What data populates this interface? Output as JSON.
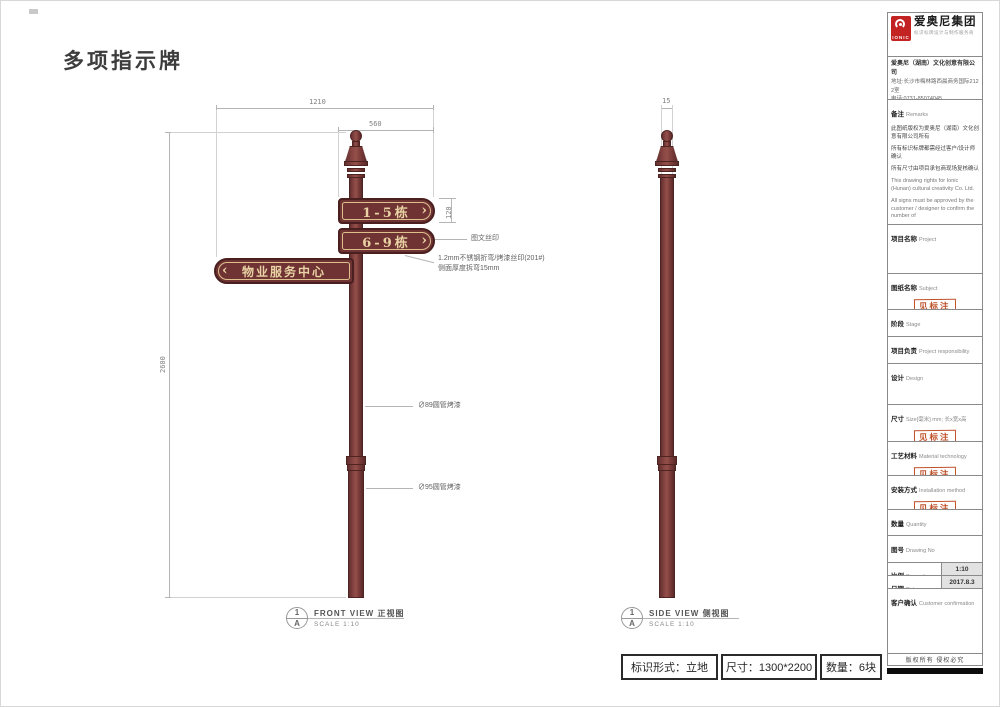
{
  "page": {
    "title": "多项指示牌",
    "copyright": "版权所有 侵权必究"
  },
  "drawing": {
    "plates": {
      "plate1": "1-5栋",
      "plate2": "6-9栋",
      "plate3": "物业服务中心",
      "arrow_right": "›",
      "arrow_left": "‹"
    },
    "dimensions": {
      "total_width": "1210",
      "plate_length": "560",
      "plate_height": "120",
      "pole_height": "2600",
      "side_thickness": "15"
    },
    "annotations": {
      "silkscreen": "图文丝印",
      "material_note_1": "1.2mm不锈钢折弯/烤漆丝印(201#)",
      "material_note_2": "侧面厚度拆弯15mm",
      "pipe_89": "∅89圆管烤漆",
      "pipe_95": "∅95圆管烤漆"
    },
    "front_view": {
      "ref_number": "1",
      "ref_letter": "A",
      "title": "FRONT VIEW  正视图",
      "scale": "SCALE 1:10"
    },
    "side_view": {
      "ref_number": "1",
      "ref_letter": "A",
      "title": "SIDE VIEW   侧视图",
      "scale": "SCALE 1:10"
    }
  },
  "footer_bar": {
    "cell1": "标识形式：立地",
    "cell2": "尺寸：1300*2200",
    "cell3": "数量：6块"
  },
  "sidebar": {
    "logo": {
      "brand_mark_text": "IONIC",
      "group_name": "爱奥尼集团",
      "tagline": "标识标牌设计与制作服务商"
    },
    "company": {
      "name": "爱奥尼（湖南）文化创意有限公司",
      "address": "地址:长沙市梅林路西晨商务国际2122室",
      "phone": "电话:0731-85074045",
      "website": "http://www.ionic.net.cn"
    },
    "remarks": {
      "label_cn": "备注",
      "label_en": "Remarks",
      "lines_cn": [
        "此图纸版权为爱奥尼（湖南）文化创意有限公司所有",
        "所有标识标牌都需经过客户/设计师确认",
        "所有尺寸由项目承包商现场复核确认"
      ],
      "lines_en": [
        "This drawing rights for Ionic (Hunan) cultural creativity Co. Ltd.",
        "All signs must be approved by the customer / designer to confirm the number of",
        "All dimensions by the project contractors on-site review confirmed"
      ]
    },
    "fields": {
      "project": {
        "label_cn": "项目名称",
        "label_en": "Project",
        "value": ""
      },
      "subject": {
        "label_cn": "图纸名称",
        "label_en": "Subject",
        "stamp": "见标注"
      },
      "stage": {
        "label_cn": "阶段",
        "label_en": "Stage",
        "value": "初期方案确认"
      },
      "responsibility": {
        "label_cn": "项目负责",
        "label_en": "Project responsibility",
        "value": ""
      },
      "design": {
        "label_cn": "设计",
        "label_en": "Design",
        "value": ""
      },
      "size": {
        "label_cn": "尺寸",
        "label_en": "Size[毫米] mm; 长x宽x高",
        "stamp": "见标注"
      },
      "material": {
        "label_cn": "工艺材料",
        "label_en": "Material technology",
        "stamp": "见标注"
      },
      "install": {
        "label_cn": "安装方式",
        "label_en": "Installation method",
        "stamp": "见标注"
      },
      "quantity": {
        "label_cn": "数量",
        "label_en": "Quantity",
        "value": ""
      },
      "drawing_no": {
        "label_cn": "图号",
        "label_en": "Drawing No",
        "value": ""
      },
      "proportion": {
        "label_cn": "比例",
        "label_en": "Proportion",
        "value": "1:10"
      },
      "date": {
        "label_cn": "日期",
        "label_en": "Date",
        "value": "2017.8.3"
      },
      "confirm": {
        "label_cn": "客户确认",
        "label_en": "Customer confirmation",
        "value": ""
      }
    }
  },
  "colors": {
    "pole_maroon": "#7c3c3a",
    "plate_maroon": "#6f3333",
    "plate_gold": "#e9d2a4",
    "stamp_red": "#c0512b",
    "logo_red": "#c32323"
  }
}
